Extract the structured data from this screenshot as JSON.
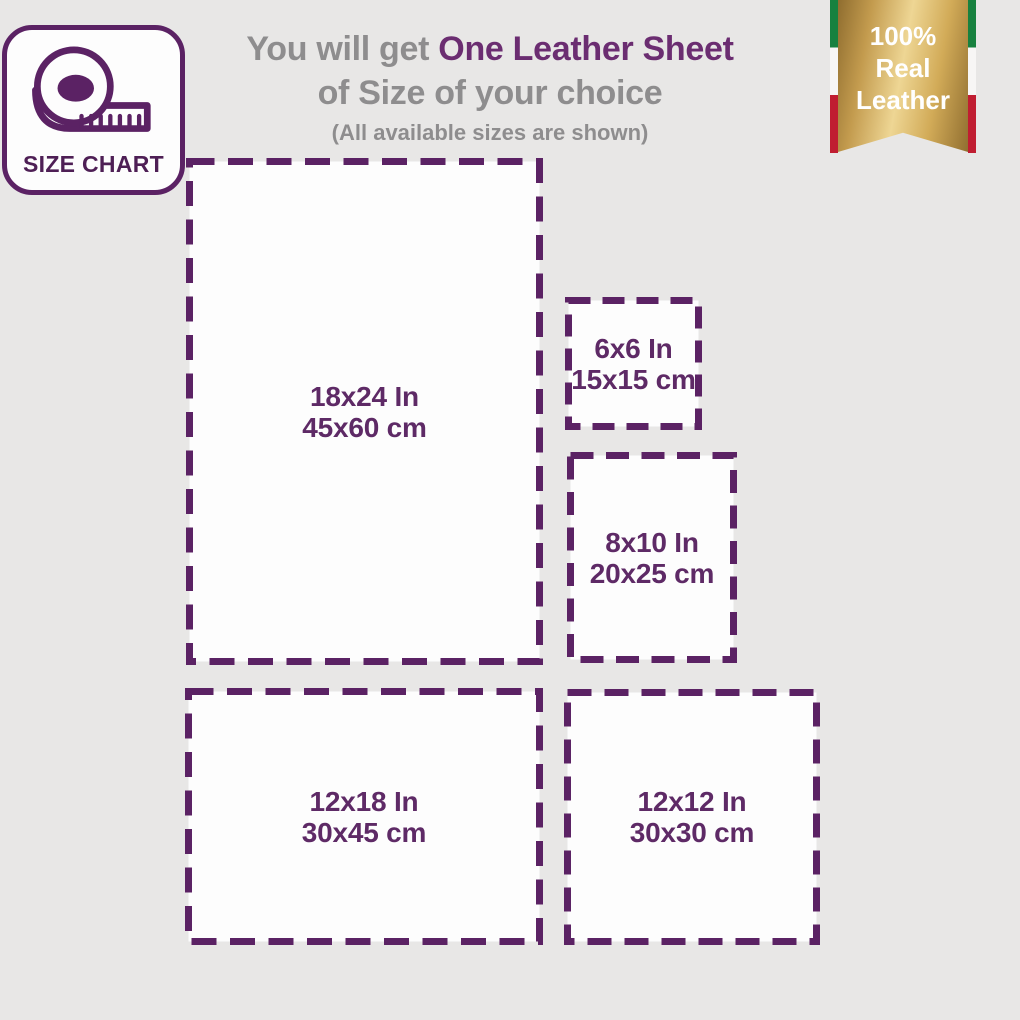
{
  "badge": {
    "label": "SIZE CHART"
  },
  "heading": {
    "prefix": "You will get ",
    "highlight": "One Leather Sheet",
    "line2": "of Size of your choice",
    "note": "(All available sizes are shown)"
  },
  "ribbon": {
    "lines": [
      "100%",
      "Real",
      "Leather"
    ]
  },
  "sizes": [
    {
      "id": "18x24",
      "in": "18x24 In",
      "cm": "45x60 cm"
    },
    {
      "id": "6x6",
      "in": "6x6 In",
      "cm": "15x15 cm"
    },
    {
      "id": "8x10",
      "in": "8x10 In",
      "cm": "20x25 cm"
    },
    {
      "id": "12x18",
      "in": "12x18 In",
      "cm": "30x45 cm"
    },
    {
      "id": "12x12",
      "in": "12x12 In",
      "cm": "30x30 cm"
    }
  ],
  "colors": {
    "background": "#e8e7e6",
    "box_fill": "#fdfdfd",
    "border_purple": "#5b2264",
    "text_purple": "#5e2a66",
    "heading_gray": "#8e8d8e",
    "heading_purple": "#6b2d71",
    "gold": "#d2ab58",
    "flag_green": "#17813f",
    "flag_red": "#c01d31",
    "ribbon_text": "#ffffff"
  }
}
